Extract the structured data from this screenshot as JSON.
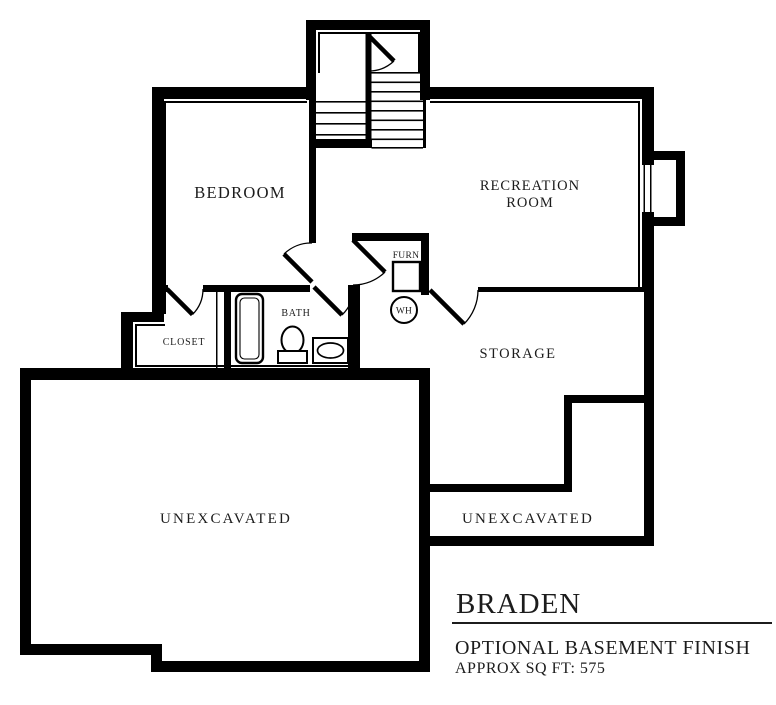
{
  "colors": {
    "ink": "#000000",
    "background": "#ffffff",
    "label_ink": "#1c1c1c"
  },
  "rooms": {
    "bedroom": "BEDROOM",
    "recreation_line1": "RECREATION",
    "recreation_line2": "ROOM",
    "storage": "STORAGE",
    "bath": "BATH",
    "closet": "CLOSET",
    "furnace": "FURN",
    "water_heater": "WH",
    "unexcavated_left": "UNEXCAVATED",
    "unexcavated_right": "UNEXCAVATED"
  },
  "title_block": {
    "plan_name": "BRADEN",
    "subtitle": "OPTIONAL BASEMENT FINISH",
    "area_note": "APPROX SQ FT: 575"
  }
}
